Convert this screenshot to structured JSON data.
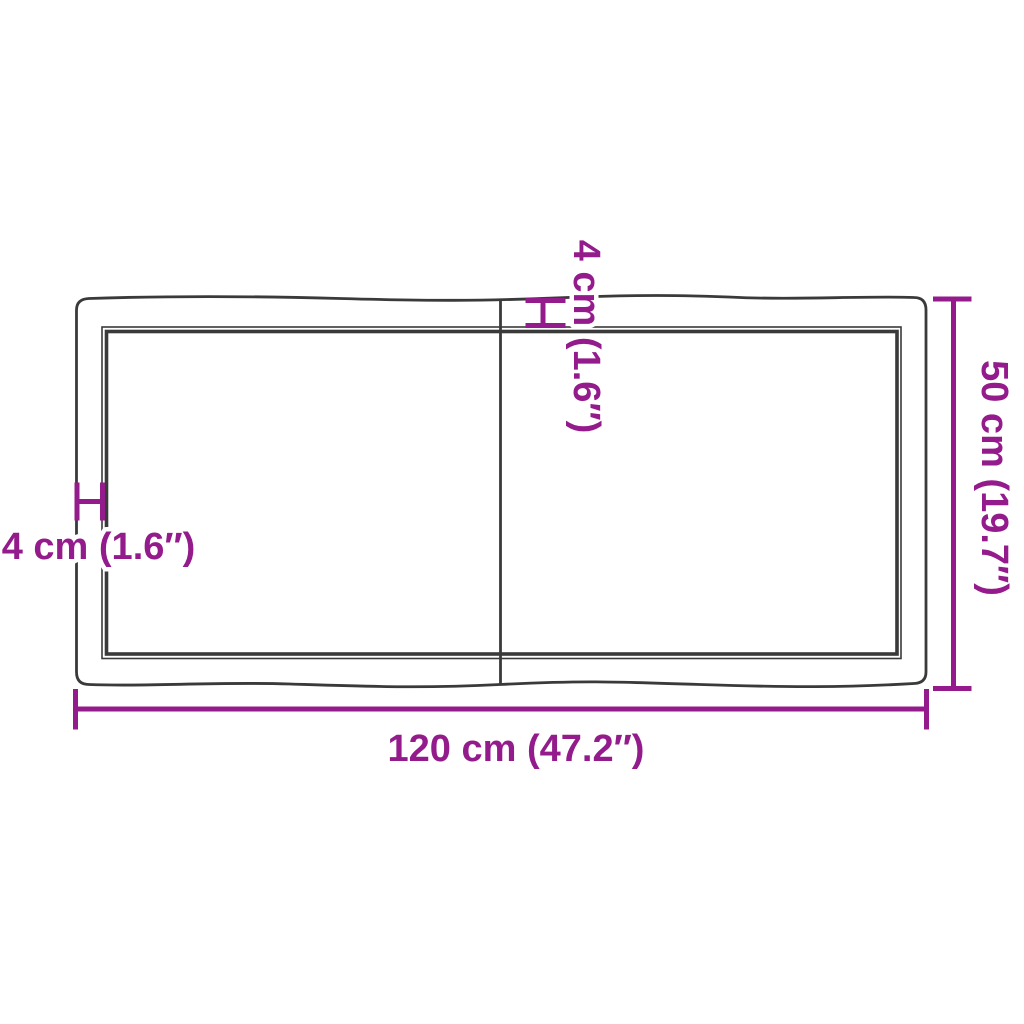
{
  "diagram": {
    "subject": "tabletop-top-view-dimension-diagram",
    "colors": {
      "accent": "#941b8c",
      "outline": "#3a3a3a",
      "background": "#ffffff"
    },
    "dimensions": {
      "width": {
        "name": "overall width",
        "label": "120 cm (47.2″)"
      },
      "height": {
        "name": "overall depth",
        "label": "50 cm (19.7″)"
      },
      "thickness_side": {
        "name": "edge thickness",
        "label": "4 cm (1.6″)"
      },
      "thickness_top": {
        "name": "edge thickness",
        "label": "4 cm (1.6″)"
      }
    }
  }
}
